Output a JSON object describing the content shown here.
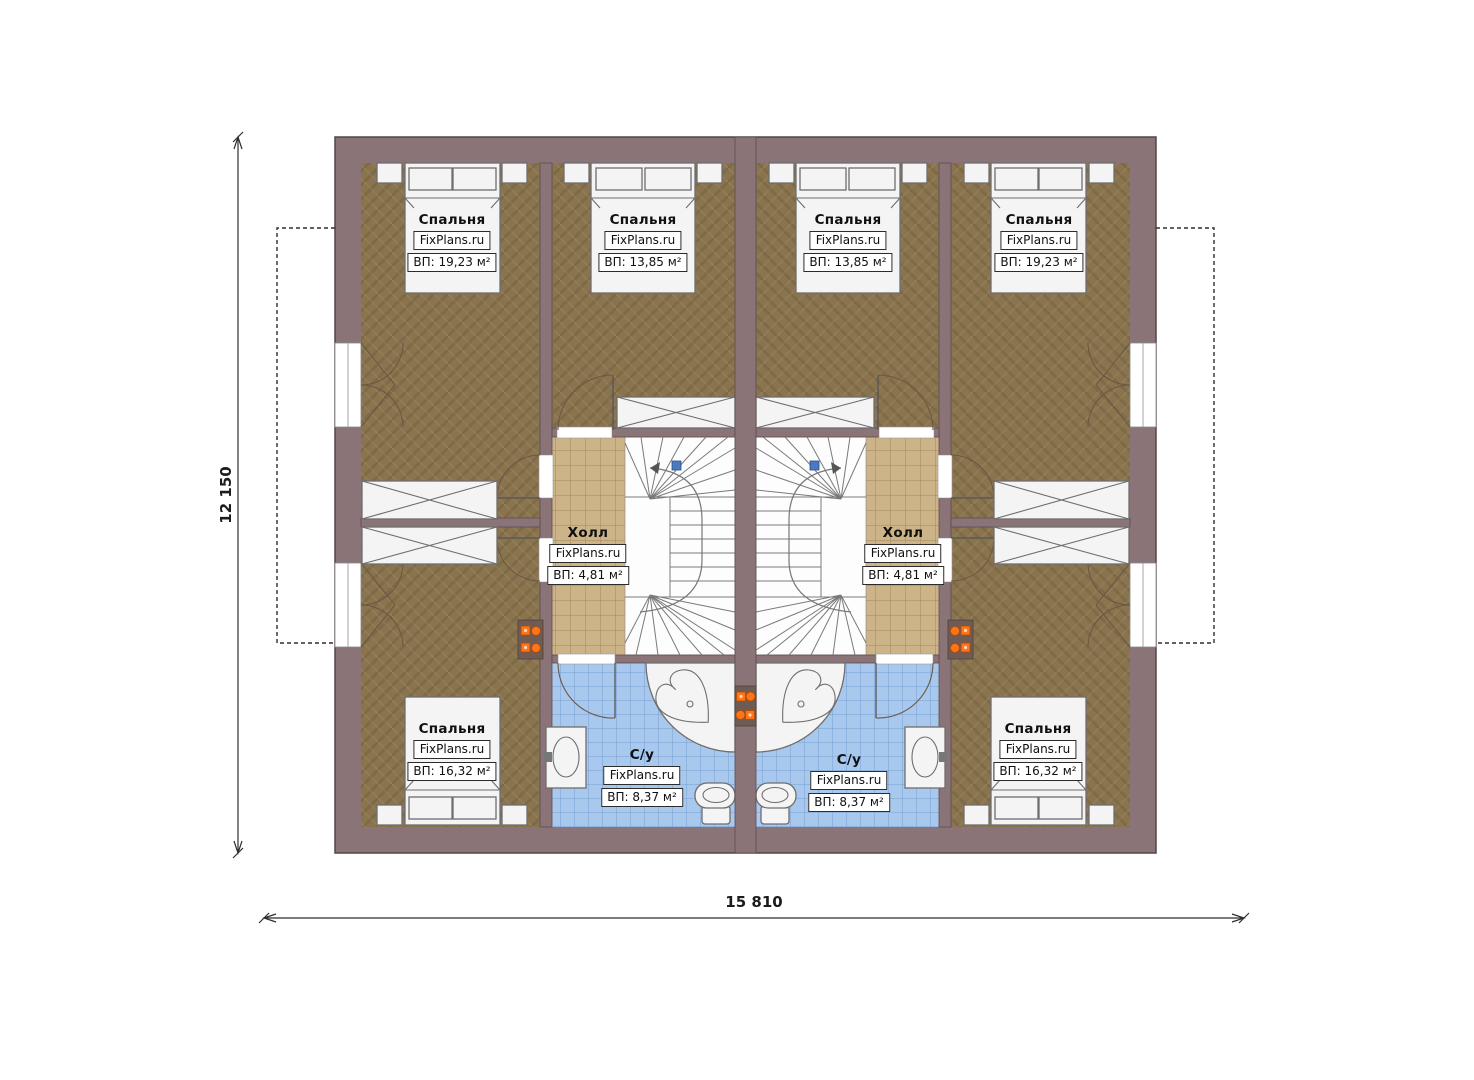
{
  "watermark": "FixPlans.ru",
  "dimensions": {
    "vertical": "12 150",
    "horizontal": "15 810"
  },
  "rooms": {
    "bedroom_top_left": {
      "name": "Спальня",
      "area": "ВП: 19,23 м²"
    },
    "bedroom_top_mid_left": {
      "name": "Спальня",
      "area": "ВП: 13,85 м²"
    },
    "bedroom_top_mid_right": {
      "name": "Спальня",
      "area": "ВП: 13,85 м²"
    },
    "bedroom_top_right": {
      "name": "Спальня",
      "area": "ВП: 19,23 м²"
    },
    "hall_left": {
      "name": "Холл",
      "area": "ВП: 4,81 м²"
    },
    "hall_right": {
      "name": "Холл",
      "area": "ВП: 4,81 м²"
    },
    "bathroom_left": {
      "name": "С/у",
      "area": "ВП: 8,37 м²"
    },
    "bathroom_right": {
      "name": "С/у",
      "area": "ВП: 8,37 м²"
    },
    "bedroom_bottom_left": {
      "name": "Спальня",
      "area": "ВП: 16,32 м²"
    },
    "bedroom_bottom_right": {
      "name": "Спальня",
      "area": "ВП: 16,32 м²"
    }
  },
  "colors": {
    "wall": "#8a7478",
    "floor_wood": "#8a744e",
    "tile_hall": "#ccb488",
    "tile_bath": "#a9c8ee",
    "fixture": "#f4f4f4",
    "vent_accent": "#ff7418",
    "stair_node": "#4a7ac0",
    "dimension": "#2f2f2f"
  }
}
